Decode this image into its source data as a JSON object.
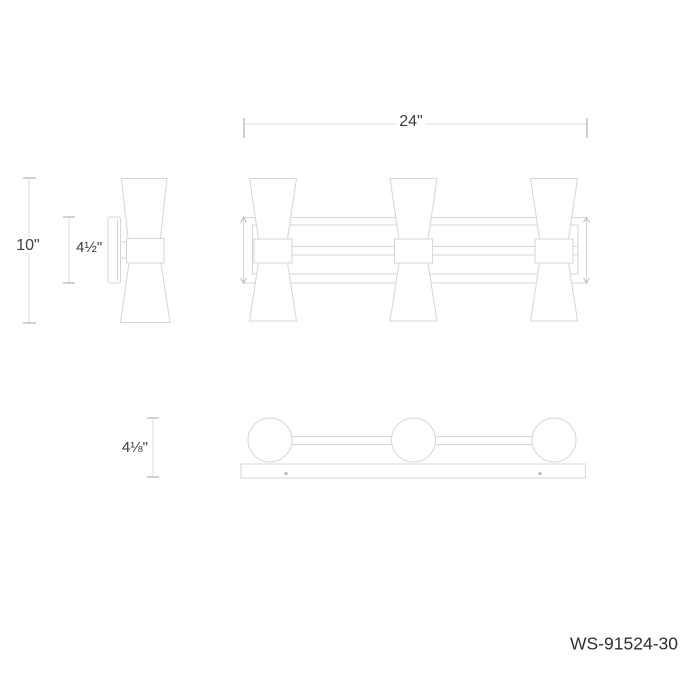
{
  "drawing": {
    "product_code": "WS-91524-30",
    "dimensions": {
      "overall_width": "24\"",
      "overall_height": "10\"",
      "backplate_height": "4½\"",
      "extension_depth": "4⅛\""
    },
    "colors": {
      "background": "#ffffff",
      "outline_gray": "#d4d6d7",
      "dimension_line_gray": "#dcdee0",
      "tick_gray": "#aeb3b6",
      "text_gray": "#3f3f3f",
      "screw_gray": "#bfc2c4"
    }
  }
}
